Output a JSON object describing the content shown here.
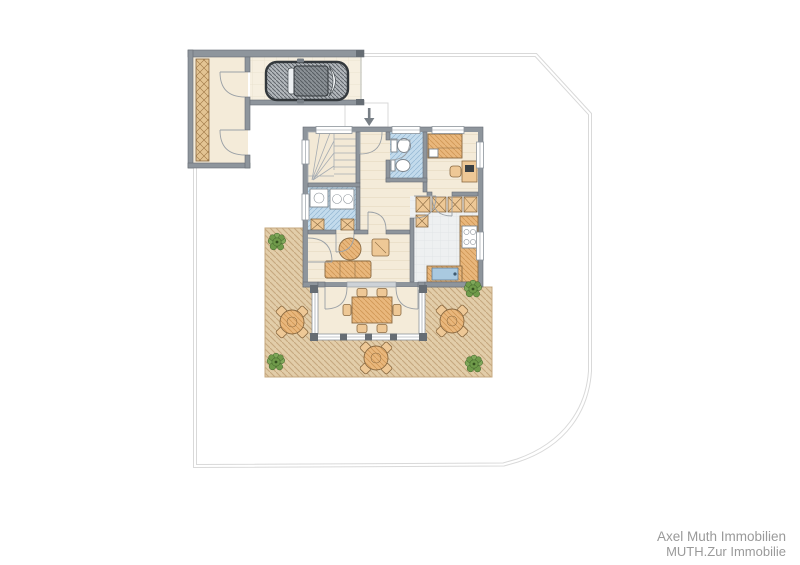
{
  "watermark": {
    "line1": "Axel Muth Immobilien",
    "line2": "MUTH.Zur Immobilie"
  },
  "palette": {
    "wall": "#8e959c",
    "wall-dark": "#666d74",
    "floor": "#f4ebd9",
    "floor-line": "#e6dac0",
    "tile-blue": "#c3dbec",
    "tile-blue-line": "#93b8d3",
    "wood": "#e9b77c",
    "wood-dark": "#8a6a42",
    "wood-light": "#eec896",
    "deck": "#e2cda9",
    "deck-line": "#c6a87f",
    "plant": "#6f9a4a",
    "plant-dark": "#3f6129",
    "boundary": "#d9d9d9",
    "watermark-text": "#9a9a9a",
    "car-dark": "#33383c",
    "kitchen-tile": "#eef0f1",
    "kitchen-tile-line": "#dde2e4",
    "window-frame": "#8d949b",
    "glass": "#ffffff"
  },
  "icons": {
    "entry-arrow": "arrow-down",
    "car": "car-top-view",
    "plant": "bush",
    "patio-table": "round-table-with-4-chairs"
  }
}
